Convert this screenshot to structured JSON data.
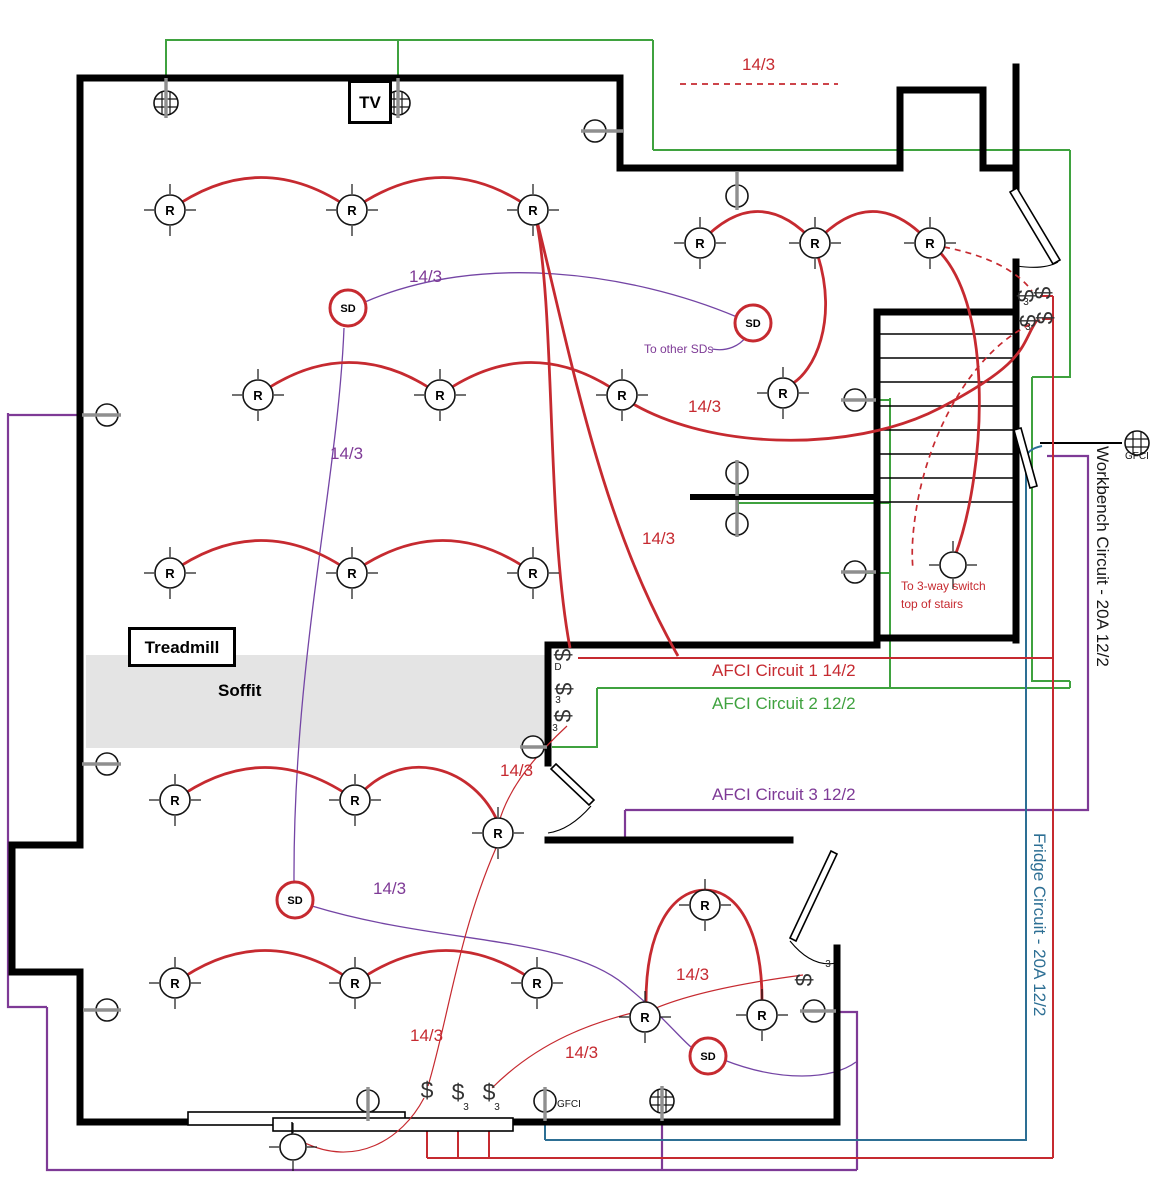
{
  "legend": {
    "wire_label": "14/3"
  },
  "rooms": {
    "tv": "TV",
    "treadmill": "Treadmill",
    "soffit": "Soffit"
  },
  "symbols": {
    "recessed_light": "R",
    "smoke_detector": "SD",
    "switch": "$",
    "three_way": "3",
    "dimmer": "D"
  },
  "circuits": {
    "afci1": {
      "label": "AFCI Circuit 1 14/2",
      "color": "#c62a30"
    },
    "afci2": {
      "label": "AFCI Circuit 2 12/2",
      "color": "#3fa23f"
    },
    "afci3": {
      "label": "AFCI Circuit 3 12/2",
      "color": "#7e3a96"
    },
    "fridge": {
      "label": "Fridge Circuit - 20A 12/2",
      "color": "#2d6f94"
    },
    "workbench": {
      "label": "Workbench Circuit - 20A 12/2",
      "color": "#161616"
    }
  },
  "notes": {
    "to_other_sds": "To other SDs",
    "three_way_line1": "To 3-way switch",
    "three_way_line2": "top of stairs",
    "gfci_right": "GFCI",
    "gfci_bottom": "GFCI"
  }
}
